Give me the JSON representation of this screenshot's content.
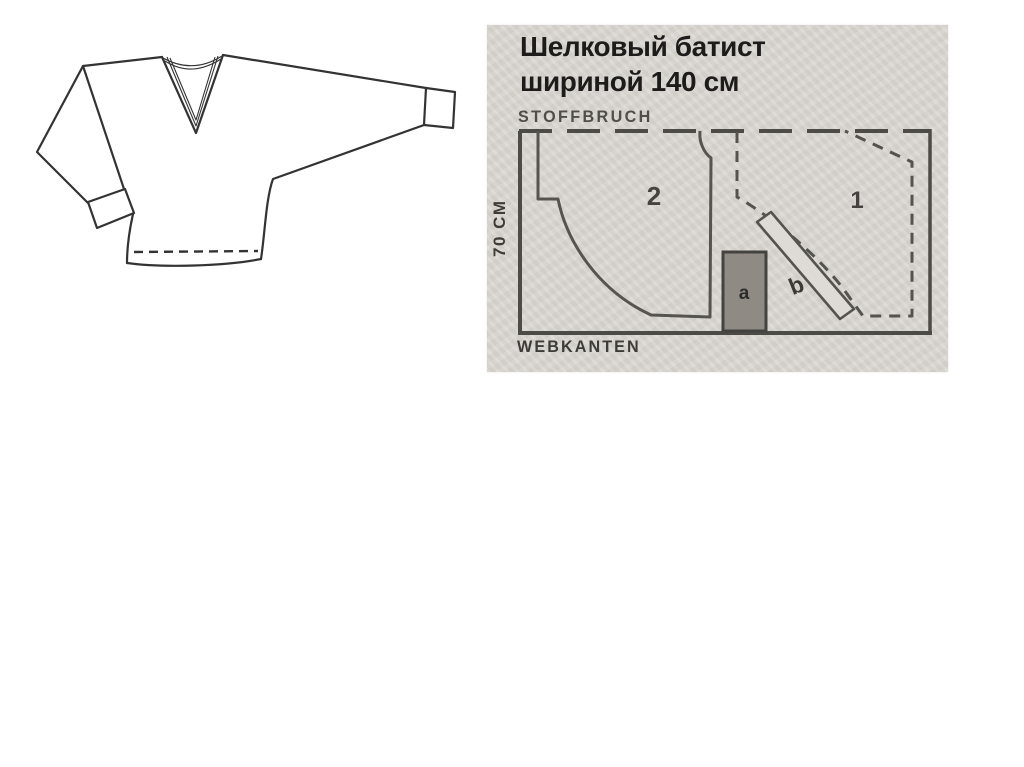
{
  "slide": {
    "background": "#ffffff"
  },
  "garment_sketch": {
    "name": "batwing-vneck-blouse-technical-drawing",
    "line_color": "#333333"
  },
  "cutting_layout": {
    "title_line1": "Шелковый батист",
    "title_line2": "шириной 140 см",
    "fold_label": "STOFFBRUCH",
    "selvage_label": "WEBKANTEN",
    "width_label": "70 CM",
    "pieces": [
      {
        "id": "2",
        "style": "solid-outline"
      },
      {
        "id": "1",
        "style": "dashed-outline"
      },
      {
        "id": "a",
        "style": "filled-rectangle"
      },
      {
        "id": "b",
        "style": "bias-strip"
      }
    ],
    "colors": {
      "panel_bg": "#d9d6d1",
      "line": "#4d4b46",
      "piece_outline": "#55534e",
      "piece_a_fill": "#8f8b84",
      "piece_a_border": "#454340",
      "text_dark": "#1d1c1a",
      "label_grey": "#504e49"
    }
  }
}
